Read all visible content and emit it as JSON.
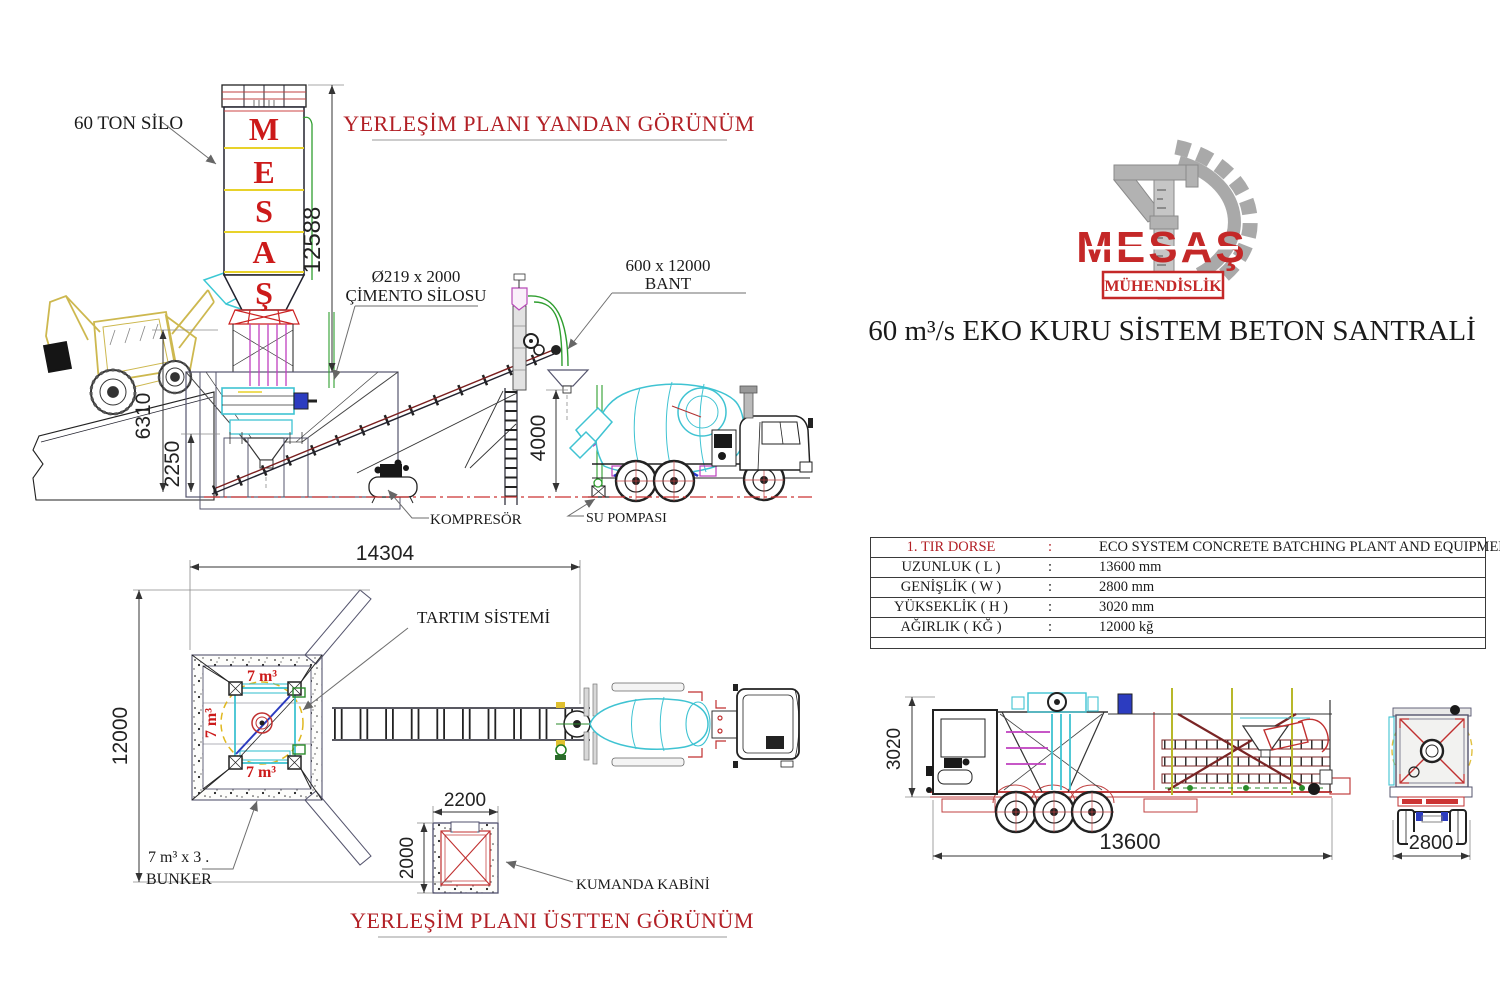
{
  "brand": {
    "logo_text": "MESAŞ",
    "logo_subtitle": "MÜHENDİSLİK",
    "main_title": "60 m³/s EKO KURU SİSTEM BETON SANTRALİ"
  },
  "side_view": {
    "title": "YERLEŞİM PLANI YANDAN GÖRÜNÜM",
    "silo_label": "60 TON SİLO",
    "silo_letters": [
      "M",
      "E",
      "S",
      "A",
      "Ş"
    ],
    "cement_silo_label": {
      "line1": "Ø219 x 2000",
      "line2": "ÇİMENTO SİLOSU"
    },
    "belt_label": {
      "line1": "600 x 12000",
      "line2": "BANT"
    },
    "compressor_label": "KOMPRESÖR",
    "water_pump_label": "SU POMPASI",
    "dims": {
      "silo_height": "12588",
      "platform_height": "6310",
      "pit_depth": "2250",
      "discharge_height": "4000"
    }
  },
  "top_view": {
    "title": "YERLEŞİM PLANI ÜSTTEN GÖRÜNÜM",
    "weighing_label": "TARTIM SİSTEMİ",
    "bunker_label": {
      "line1": "7 m³ x 3 .",
      "line2": "BUNKER"
    },
    "bunker_cell_label": "7 m³",
    "control_cabin_label": "KUMANDA KABİNİ",
    "dims": {
      "total_length": "14304",
      "total_width": "12000",
      "cabin_width": "2200",
      "cabin_depth": "2000"
    }
  },
  "spec_table": {
    "rows": [
      {
        "label": "1. TIR DORSE",
        "colon": ":",
        "value": "ECO SYSTEM CONCRETE BATCHING PLANT AND EQUIPMENT"
      },
      {
        "label": "UZUNLUK ( L )",
        "colon": ":",
        "value": "13600 mm"
      },
      {
        "label": "GENİŞLİK ( W )",
        "colon": ":",
        "value": "2800 mm"
      },
      {
        "label": "YÜKSEKLİK ( H )",
        "colon": ":",
        "value": "3020 mm"
      },
      {
        "label": "AĞIRLIK ( KĞ )",
        "colon": ":",
        "value": "12000 kğ"
      }
    ]
  },
  "trailer_view": {
    "dims": {
      "height": "3020",
      "length": "13600",
      "width": "2800"
    }
  },
  "colors": {
    "title_red": "#b22026",
    "drawing_red": "#cc1a1a",
    "line_dark": "#22222e",
    "outline_navy": "#55556e",
    "cyan": "#3fc3d2",
    "magenta": "#bf3fbf",
    "green": "#2f9e2f",
    "yellow": "#d9c24f",
    "dim_gray": "#777777",
    "logo_gray": "#a9a9a9",
    "logo_red": "#c42828"
  }
}
